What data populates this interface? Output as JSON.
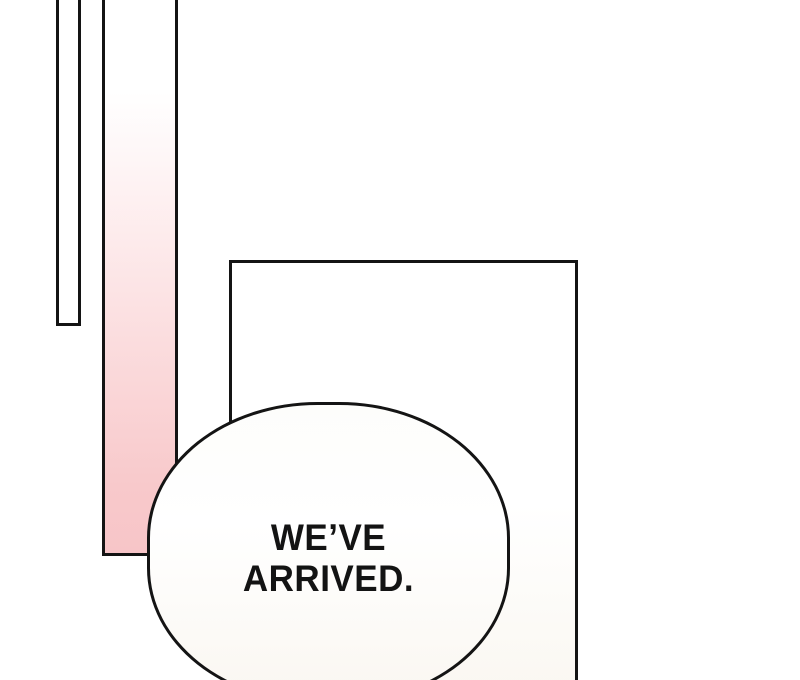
{
  "panel": {
    "type": "comic-panel",
    "speech_bubble": {
      "lines": [
        "WE’VE",
        "ARRIVED."
      ]
    },
    "colors": {
      "outline": "#141414",
      "pink": "#f8c9cb",
      "pink_light": "#fdeaeb",
      "cream": "#faf7f1",
      "background": "#ffffff",
      "bubble_fill": "#fdfdfb"
    }
  }
}
